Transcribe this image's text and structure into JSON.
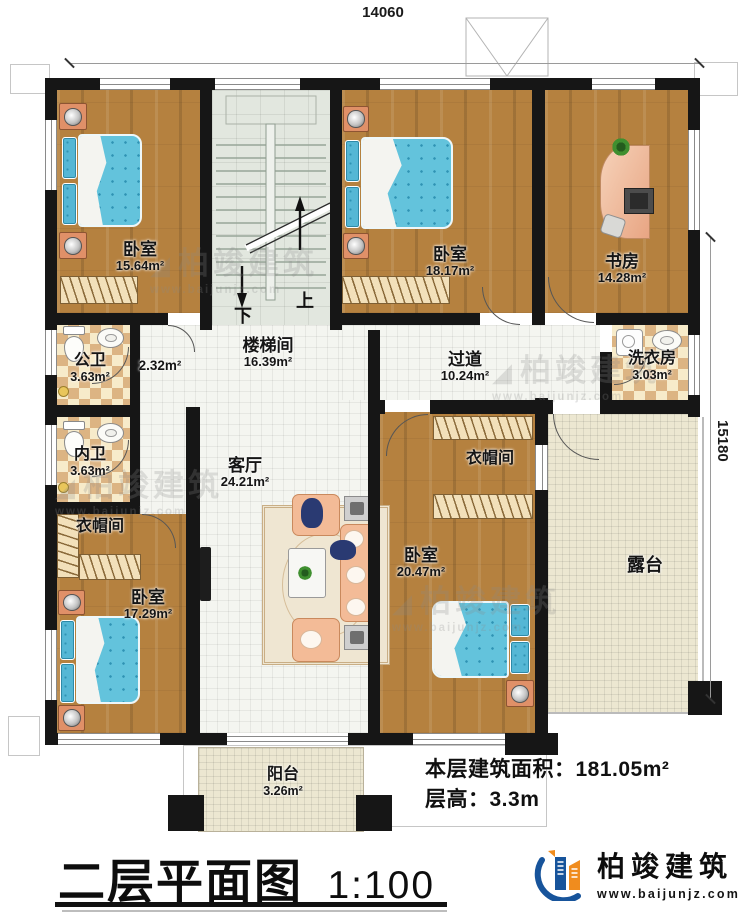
{
  "dimensions": {
    "width_top": "14060",
    "height_right": "15180"
  },
  "rooms": [
    {
      "id": "bedroom-top-left",
      "name": "卧室",
      "area": "15.64m²"
    },
    {
      "id": "stairwell",
      "name": "楼梯间",
      "area": "16.39m²"
    },
    {
      "id": "bedroom-top-middle",
      "name": "卧室",
      "area": "18.17m²"
    },
    {
      "id": "study",
      "name": "书房",
      "area": "14.28m²"
    },
    {
      "id": "public-bathroom",
      "name": "公卫",
      "area": "3.63m²"
    },
    {
      "id": "hallway",
      "name": "",
      "area": "2.32m²"
    },
    {
      "id": "private-bathroom",
      "name": "内卫",
      "area": "3.63m²"
    },
    {
      "id": "closet-left",
      "name": "衣帽间",
      "area": ""
    },
    {
      "id": "living-room",
      "name": "客厅",
      "area": "24.21m²"
    },
    {
      "id": "corridor",
      "name": "过道",
      "area": "10.24m²"
    },
    {
      "id": "laundry",
      "name": "洗衣房",
      "area": "3.03m²"
    },
    {
      "id": "closet-right",
      "name": "衣帽间",
      "area": ""
    },
    {
      "id": "bedroom-bottom-right",
      "name": "卧室",
      "area": "20.47m²"
    },
    {
      "id": "terrace",
      "name": "露台",
      "area": ""
    },
    {
      "id": "bedroom-bottom-left",
      "name": "卧室",
      "area": "17.29m²"
    },
    {
      "id": "balcony",
      "name": "阳台",
      "area": "3.26m²"
    }
  ],
  "stairs": {
    "up": "上",
    "down": "下"
  },
  "info": {
    "area_label": "本层建筑面积：",
    "area_value": "181.05m²",
    "height_label": "层高：",
    "height_value": "3.3m"
  },
  "title": {
    "main": "二层平面图",
    "scale": "1:100"
  },
  "brand": {
    "name": "柏竣建筑",
    "website": "www.baijunjz.com"
  },
  "colors": {
    "wall": "#161616",
    "wood_floor": "#b5813f",
    "bed_blue": "#63c3dc",
    "brand_blue": "#17549b",
    "brand_orange": "#f08c1e"
  }
}
